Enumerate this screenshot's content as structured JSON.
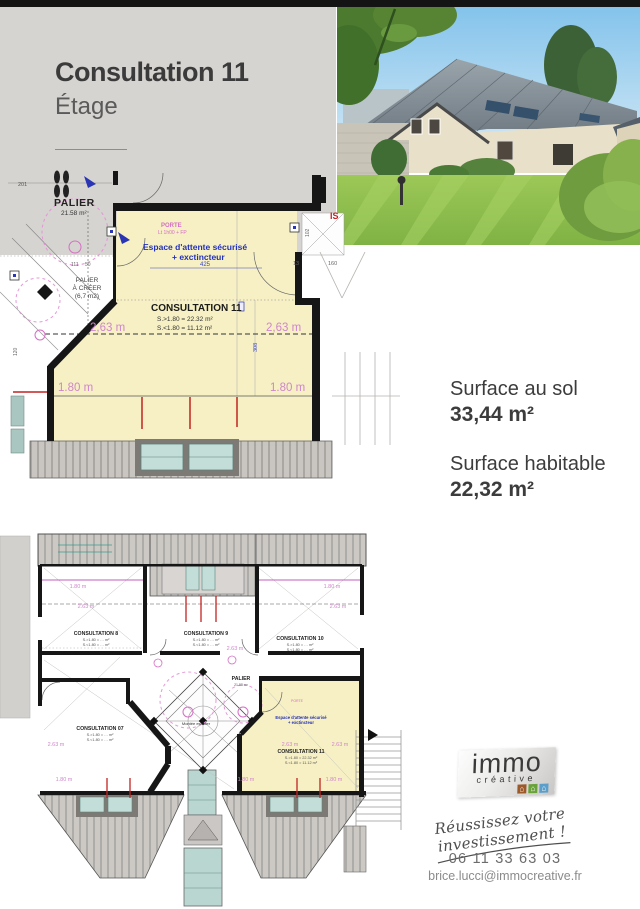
{
  "header": {
    "title": "Consultation 11",
    "subtitle": "Étage"
  },
  "surfaces": {
    "floor_label": "Surface au sol",
    "floor_value": "33,44 m²",
    "living_label": "Surface habitable",
    "living_value": "22,32 m²"
  },
  "main_plan": {
    "palier": "PALIER",
    "palier_area": "21.58 m²",
    "palier_creer_1": "PALIER",
    "palier_creer_2": "À CRÉER",
    "palier_creer_3": "(6,7 m2)",
    "porte": "PORTE",
    "porte_sub": "Lt 1h00 + FP",
    "espace_1": "Espace d'attente sécurisé",
    "espace_2": "+ exctincteur",
    "room_title": "CONSULTATION 11",
    "room_s1": "S.>1.80 = 22.32 m²",
    "room_s2": "S.<1.80 = 11.12 m²",
    "dim_263": "2,63 m",
    "dim_180": "1.80 m",
    "dim_425": "425",
    "dim_201": "201",
    "dim_111": "111",
    "dim_50": "50",
    "dim_120": "120",
    "dim_13": "13",
    "dim_160": "160",
    "dim_102": "102",
    "dim_308": "308",
    "is_label": "IS"
  },
  "bottom_plan": {
    "room8": "CONSULTATION 8",
    "room9": "CONSULTATION 9",
    "room10": "CONSULTATION 10",
    "room07": "CONSULTATION 07",
    "room11": "CONSULTATION 11",
    "sub1": "S.>1.80 = … m²",
    "sub2": "S.<1.80 = … m²",
    "room11_s1": "S.>1.80 = 22.32 m²",
    "room11_s2": "S.<1.80 = 11.12 m²",
    "palier": "PALIER",
    "montee": "Montée escalier",
    "espace_1": "Espace d'attente sécurisé",
    "espace_2": "+ exctincteur",
    "dim_180": "1.80 m",
    "dim_263": "2.63 m"
  },
  "branding": {
    "logo_line1": "immo",
    "logo_line2": "créative",
    "tagline": "Réussissez votre investissement !",
    "phone": "06 11 33 63 03",
    "email": "brice.lucci@immocreative.fr"
  },
  "colors": {
    "plan_yellow": "#f6f0c4",
    "plan_gray": "#d6d4d0",
    "teal": "#c3ded9",
    "wall": "#161616",
    "pink": "#cf86cc",
    "blue_note": "#2330b8",
    "red_mark": "#c32222"
  }
}
